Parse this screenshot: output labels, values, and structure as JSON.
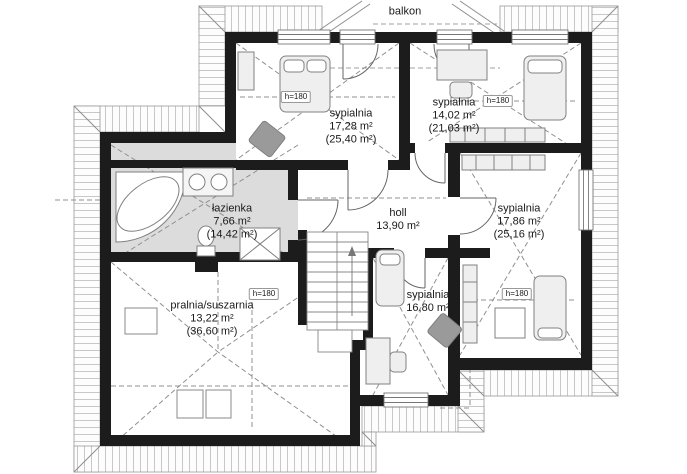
{
  "plan_labels": {
    "balcony": "balkon",
    "height_marker": "h=180"
  },
  "rooms": {
    "bedroom_top_left": {
      "name": "sypialnia",
      "area": "17,28 m²",
      "floor_area": "(25,40 m²)"
    },
    "bedroom_top_right": {
      "name": "sypialnia",
      "area": "14,02 m²",
      "floor_area": "(21,03 m²)"
    },
    "bedroom_right": {
      "name": "sypialnia",
      "area": "17,86 m²",
      "floor_area": "(25,16 m²)"
    },
    "bedroom_bottom": {
      "name": "sypialnia",
      "area": "16,80 m²"
    },
    "bathroom": {
      "name": "łazienka",
      "area": "7,66 m²",
      "floor_area": "(14,42 m²)"
    },
    "hall": {
      "name": "holl",
      "area": "13,90 m²"
    },
    "laundry": {
      "name": "pralnia/suszarnia",
      "area": "13,22 m²",
      "floor_area": "(36,60 m²)"
    }
  },
  "colors": {
    "wall": "#1c1c1c",
    "bathroom_floor": "#dcdcdc",
    "hatch_line": "#b5b5b5",
    "dash_line": "#909090",
    "furniture_dark": "#9a9a9a"
  }
}
